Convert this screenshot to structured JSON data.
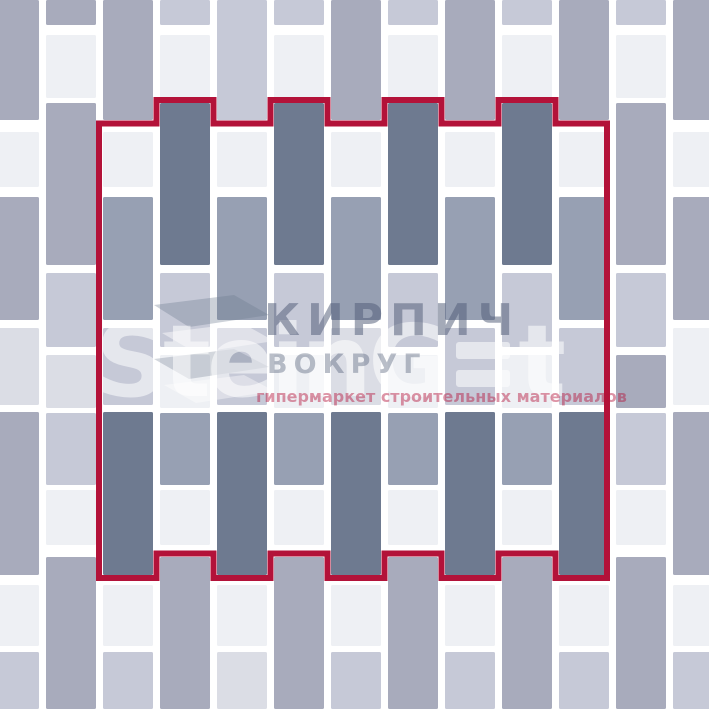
{
  "canvas": {
    "width": 709,
    "height": 709,
    "background": "#ffffff"
  },
  "palette": {
    "dark": "#6e7a90",
    "mid": "#a8abbc",
    "mid2": "#97a0b3",
    "light": "#eef0f4",
    "lav": "#c6c9d7",
    "lav2": "#dbdde5",
    "red": "#b31239"
  },
  "grid": {
    "tile_width": 50,
    "column_pitch": 57,
    "gap": 7,
    "row_templates": {
      "even": [
        [
          0,
          120
        ],
        [
          132,
          55
        ],
        [
          197,
          123
        ],
        [
          328,
          77
        ],
        [
          412,
          163
        ],
        [
          585,
          61
        ],
        [
          652,
          57
        ]
      ],
      "odd": [
        [
          0,
          25
        ],
        [
          35,
          63
        ],
        [
          103,
          162
        ],
        [
          273,
          74
        ],
        [
          355,
          53
        ],
        [
          413,
          72
        ],
        [
          490,
          55
        ],
        [
          557,
          152
        ]
      ]
    },
    "columns": [
      {
        "x": -11,
        "type": "even",
        "colors": [
          "mid",
          "light",
          "mid",
          "lav2",
          "mid",
          "light",
          "lav"
        ]
      },
      {
        "x": 46,
        "type": "odd",
        "colors": [
          "mid",
          "light",
          "mid",
          "lav",
          "lav2",
          "lav",
          "light",
          "mid"
        ]
      },
      {
        "x": 103,
        "type": "even",
        "colors": [
          "mid",
          "light",
          "mid2",
          "lav",
          "dark",
          "light",
          "lav"
        ]
      },
      {
        "x": 160,
        "type": "odd",
        "colors": [
          "lav",
          "light",
          "dark",
          "lav",
          "light",
          "mid2",
          "light",
          "mid"
        ]
      },
      {
        "x": 217,
        "type": "even",
        "colors": [
          "lav",
          "light",
          "mid2",
          "lav",
          "dark",
          "light",
          "lav2"
        ]
      },
      {
        "x": 274,
        "type": "odd",
        "colors": [
          "lav",
          "light",
          "dark",
          "lav",
          "light",
          "mid2",
          "light",
          "mid"
        ]
      },
      {
        "x": 331,
        "type": "even",
        "colors": [
          "mid",
          "light",
          "mid2",
          "lav2",
          "dark",
          "light",
          "lav"
        ]
      },
      {
        "x": 388,
        "type": "odd",
        "colors": [
          "lav",
          "light",
          "dark",
          "lav",
          "light",
          "mid2",
          "light",
          "mid"
        ]
      },
      {
        "x": 445,
        "type": "even",
        "colors": [
          "mid",
          "light",
          "mid2",
          "lav",
          "dark",
          "light",
          "lav"
        ]
      },
      {
        "x": 502,
        "type": "odd",
        "colors": [
          "lav",
          "light",
          "dark",
          "lav",
          "light",
          "mid2",
          "light",
          "mid"
        ]
      },
      {
        "x": 559,
        "type": "even",
        "colors": [
          "mid",
          "light",
          "mid2",
          "lav",
          "dark",
          "light",
          "lav"
        ]
      },
      {
        "x": 616,
        "type": "odd",
        "colors": [
          "lav",
          "light",
          "mid",
          "lav",
          "mid",
          "lav",
          "light",
          "mid"
        ]
      },
      {
        "x": 673,
        "type": "even",
        "colors": [
          "mid",
          "light",
          "mid",
          "light",
          "mid",
          "light",
          "lav"
        ]
      }
    ]
  },
  "outline": {
    "stroke_width": 6,
    "path": "M 99 123.5 H 156.5 V 100 H 213.5 V 123.5 H 270.5 V 100 H 327.5 V 123.5 H 384.5 V 100 H 441.5 V 123.5 H 498.5 V 100 H 555.5 V 123.5 H 607 V 578 H 555.5 V 553.5 H 498.5 V 578 H 441.5 V 553.5 H 384.5 V 578 H 327.5 V 553.5 H 270.5 V 578 H 213.5 V 553.5 H 156.5 V 578 H 99 Z"
  },
  "watermark": {
    "brand_main": "SteinG",
    "brand_tail": "t",
    "line1": "КИРПИЧ",
    "line2": "ВОКРУГ",
    "tagline": "гипермаркет строительных материалов"
  }
}
